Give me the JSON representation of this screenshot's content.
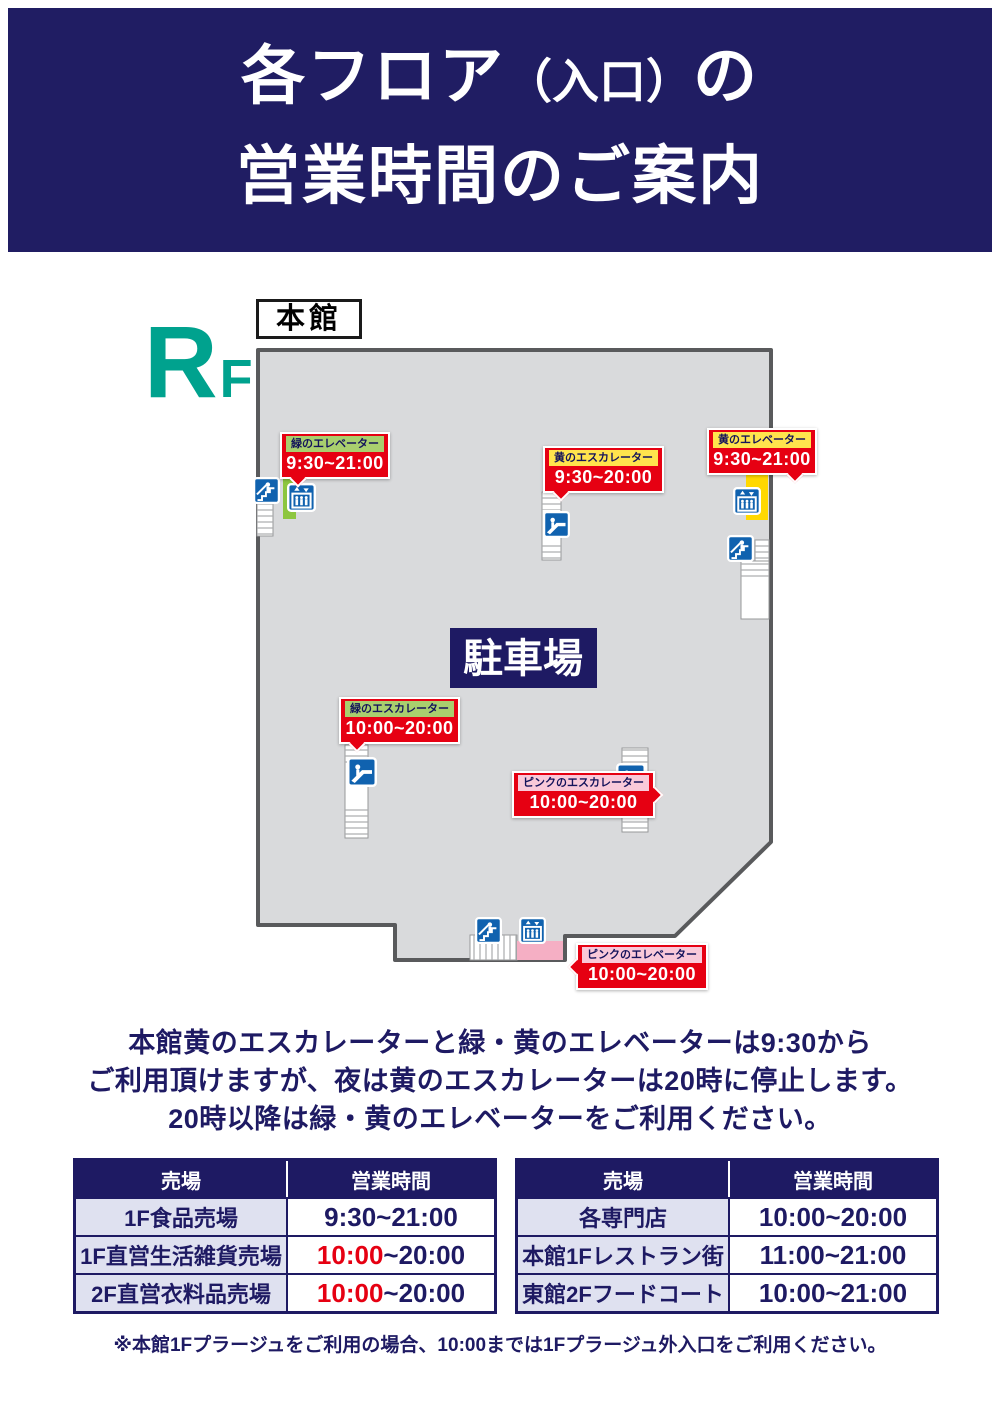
{
  "poster": {
    "title_line1_a": "各フロア",
    "title_line1_b": "（入口）",
    "title_line1_c": "の",
    "title_line2": "営業時間のご案内",
    "floor_letter": "R",
    "floor_letter_sub": "F",
    "building_label": "本館",
    "parking_label": "駐車場",
    "map_markers": [
      {
        "facility": "緑のエレベーター",
        "hours": "9:30~21:00",
        "chip_color": "green"
      },
      {
        "facility": "黄のエスカレーター",
        "hours": "9:30~20:00",
        "chip_color": "yellow"
      },
      {
        "facility": "黄のエレベーター",
        "hours": "9:30~21:00",
        "chip_color": "yellow"
      },
      {
        "facility": "緑のエスカレーター",
        "hours": "10:00~20:00",
        "chip_color": "green"
      },
      {
        "facility": "ピンクのエスカレーター",
        "hours": "10:00~20:00",
        "chip_color": "pink"
      },
      {
        "facility": "ピンクのエレベーター",
        "hours": "10:00~20:00",
        "chip_color": "pink"
      }
    ],
    "icons": {
      "elevator": "elevator-icon",
      "escalator": "escalator-icon",
      "stairs": "stairs-icon"
    },
    "notice_lines": [
      "本館黄のエスカレーターと緑・黄のエレベーターは9:30から",
      "ご利用頂けますが、夜は黄のエスカレーターは20時に停止します。",
      "20時以降は緑・黄のエレベーターをご利用ください。"
    ],
    "tables": [
      {
        "header_shop": "売場",
        "header_hours": "営業時間",
        "rows": [
          {
            "label": "1F食品売場",
            "time_red": "",
            "time_main": "9:30~21:00"
          },
          {
            "label": "1F直営生活雑貨売場",
            "time_red": "10:00",
            "time_main": "~20:00"
          },
          {
            "label": "2F直営衣料品売場",
            "time_red": "10:00",
            "time_main": "~20:00"
          }
        ]
      },
      {
        "header_shop": "売場",
        "header_hours": "営業時間",
        "rows": [
          {
            "label": "各専門店",
            "time_red": "",
            "time_main": "10:00~20:00"
          },
          {
            "label": "本館1Fレストラン街",
            "time_red": "",
            "time_main": "11:00~21:00"
          },
          {
            "label": "東館2Fフードコート",
            "time_red": "",
            "time_main": "10:00~21:00"
          }
        ]
      }
    ],
    "footnote": "※本館1Fプラージュをご利用の場合、10:00までは1Fプラージュ外入口をご利用ください。",
    "colors": {
      "navy": "#1e1a63",
      "red": "#e60012",
      "teal": "#00a28e",
      "map_gray": "#d9dadc",
      "icon_blue": "#1062af",
      "green_bar": "#8dc63f",
      "yellow_bar": "#ffd800",
      "pink_bar": "#f5afc4",
      "chip_green": "#a9cf6e",
      "chip_yellow": "#ffe44d",
      "chip_pink": "#f9c9d9",
      "row_label_bg": "#dfe1f0"
    }
  }
}
